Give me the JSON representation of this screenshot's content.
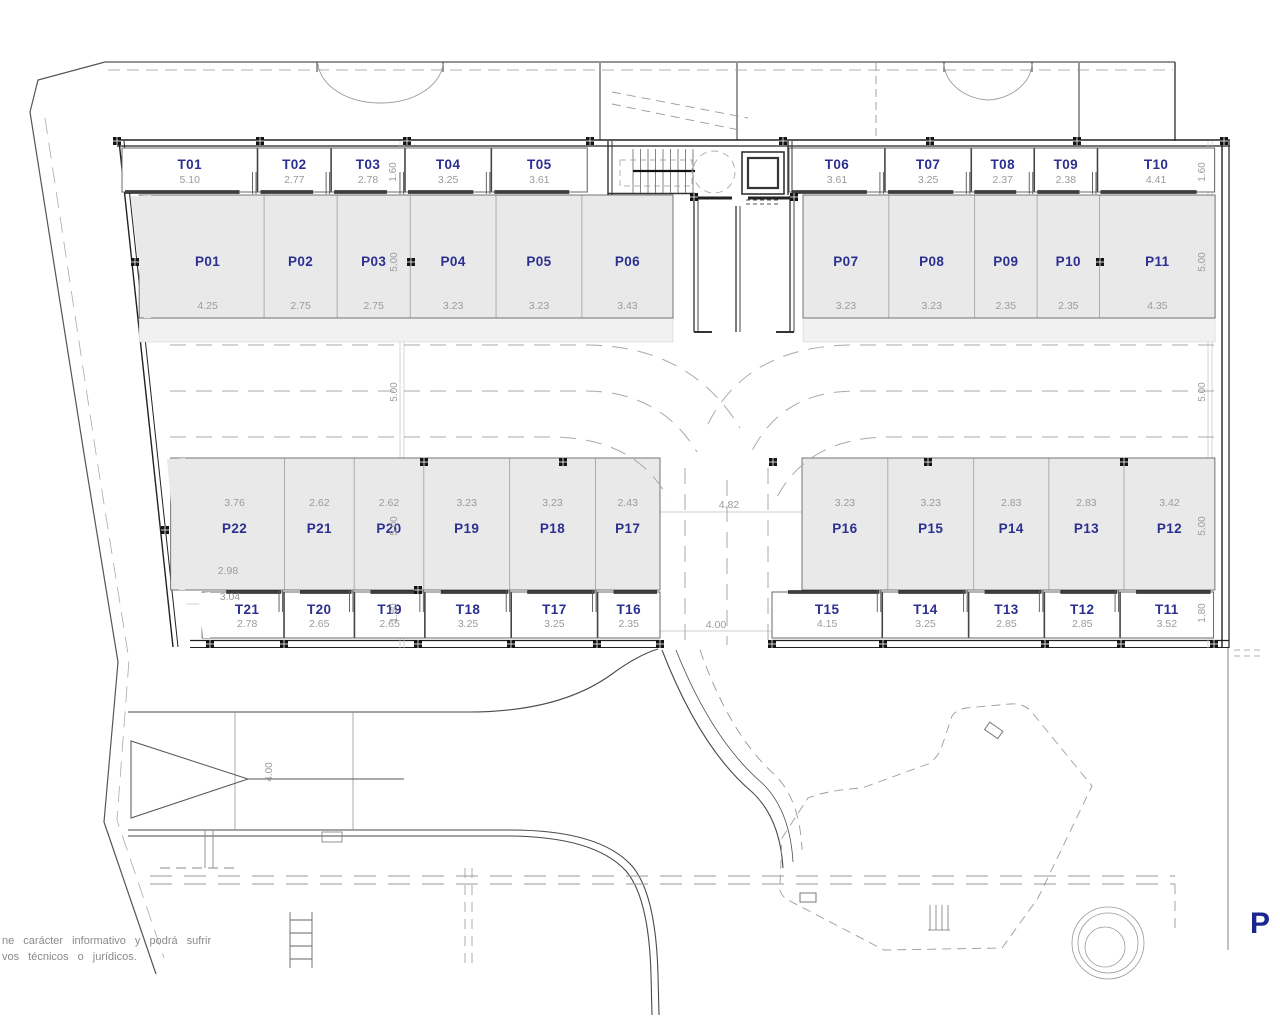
{
  "plan": {
    "title_letter": "P",
    "disclaimer": {
      "line1": "ne carácter informativo y podrá sufrir",
      "line2": "vos técnicos o jurídicos."
    },
    "colors": {
      "label_blue": "#2b2f90",
      "dim_gray": "#9b9b9b",
      "stall_fill": "#e9e9ea",
      "stall_fill_light": "#f1f1f2",
      "wall_dark": "#222222",
      "line_gray": "#555555"
    },
    "stalls": {
      "top_trasteros": [
        {
          "id": "T01",
          "dim": "5.10"
        },
        {
          "id": "T02",
          "dim": "2.77"
        },
        {
          "id": "T03",
          "dim": "2.78"
        },
        {
          "id": "T04",
          "dim": "3.25"
        },
        {
          "id": "T05",
          "dim": "3.61"
        },
        {
          "id": "T06",
          "dim": "3.61"
        },
        {
          "id": "T07",
          "dim": "3.25"
        },
        {
          "id": "T08",
          "dim": "2.37"
        },
        {
          "id": "T09",
          "dim": "2.38"
        },
        {
          "id": "T10",
          "dim": "4.41"
        }
      ],
      "top_parking": [
        {
          "id": "P01",
          "dim": "4.25"
        },
        {
          "id": "P02",
          "dim": "2.75"
        },
        {
          "id": "P03",
          "dim": "2.75"
        },
        {
          "id": "P04",
          "dim": "3.23"
        },
        {
          "id": "P05",
          "dim": "3.23"
        },
        {
          "id": "P06",
          "dim": "3.43"
        },
        {
          "id": "P07",
          "dim": "3.23"
        },
        {
          "id": "P08",
          "dim": "3.23"
        },
        {
          "id": "P09",
          "dim": "2.35"
        },
        {
          "id": "P10",
          "dim": "2.35"
        },
        {
          "id": "P11",
          "dim": "4.35"
        }
      ],
      "bottom_parking": [
        {
          "id": "P22",
          "dim": "3.76"
        },
        {
          "id": "P21",
          "dim": "2.62"
        },
        {
          "id": "P20",
          "dim": "2.62"
        },
        {
          "id": "P19",
          "dim": "3.23"
        },
        {
          "id": "P18",
          "dim": "3.23"
        },
        {
          "id": "P17",
          "dim": "2.43"
        },
        {
          "id": "P16",
          "dim": "3.23"
        },
        {
          "id": "P15",
          "dim": "3.23"
        },
        {
          "id": "P14",
          "dim": "2.83"
        },
        {
          "id": "P13",
          "dim": "2.83"
        },
        {
          "id": "P12",
          "dim": "3.42"
        }
      ],
      "bottom_trasteros": [
        {
          "id": "T21",
          "dim": "2.78"
        },
        {
          "id": "T20",
          "dim": "2.65"
        },
        {
          "id": "T19",
          "dim": "2.65"
        },
        {
          "id": "T18",
          "dim": "3.25"
        },
        {
          "id": "T17",
          "dim": "3.25"
        },
        {
          "id": "T16",
          "dim": "2.35"
        },
        {
          "id": "T15",
          "dim": "4.15"
        },
        {
          "id": "T14",
          "dim": "3.25"
        },
        {
          "id": "T13",
          "dim": "2.85"
        },
        {
          "id": "T12",
          "dim": "2.85"
        },
        {
          "id": "T11",
          "dim": "3.52"
        }
      ]
    },
    "dimensions": {
      "top_storage_depth": "1.60",
      "parking_depth": "5.00",
      "aisle_width": "5.00",
      "bottom_storage_depth": "1.80",
      "center_gap_width": "4.82",
      "center_gap_south_width": "4.00",
      "ramp_width": "4.00",
      "p22_inner_width": "2.98",
      "p22_outer_width": "3.04"
    }
  }
}
